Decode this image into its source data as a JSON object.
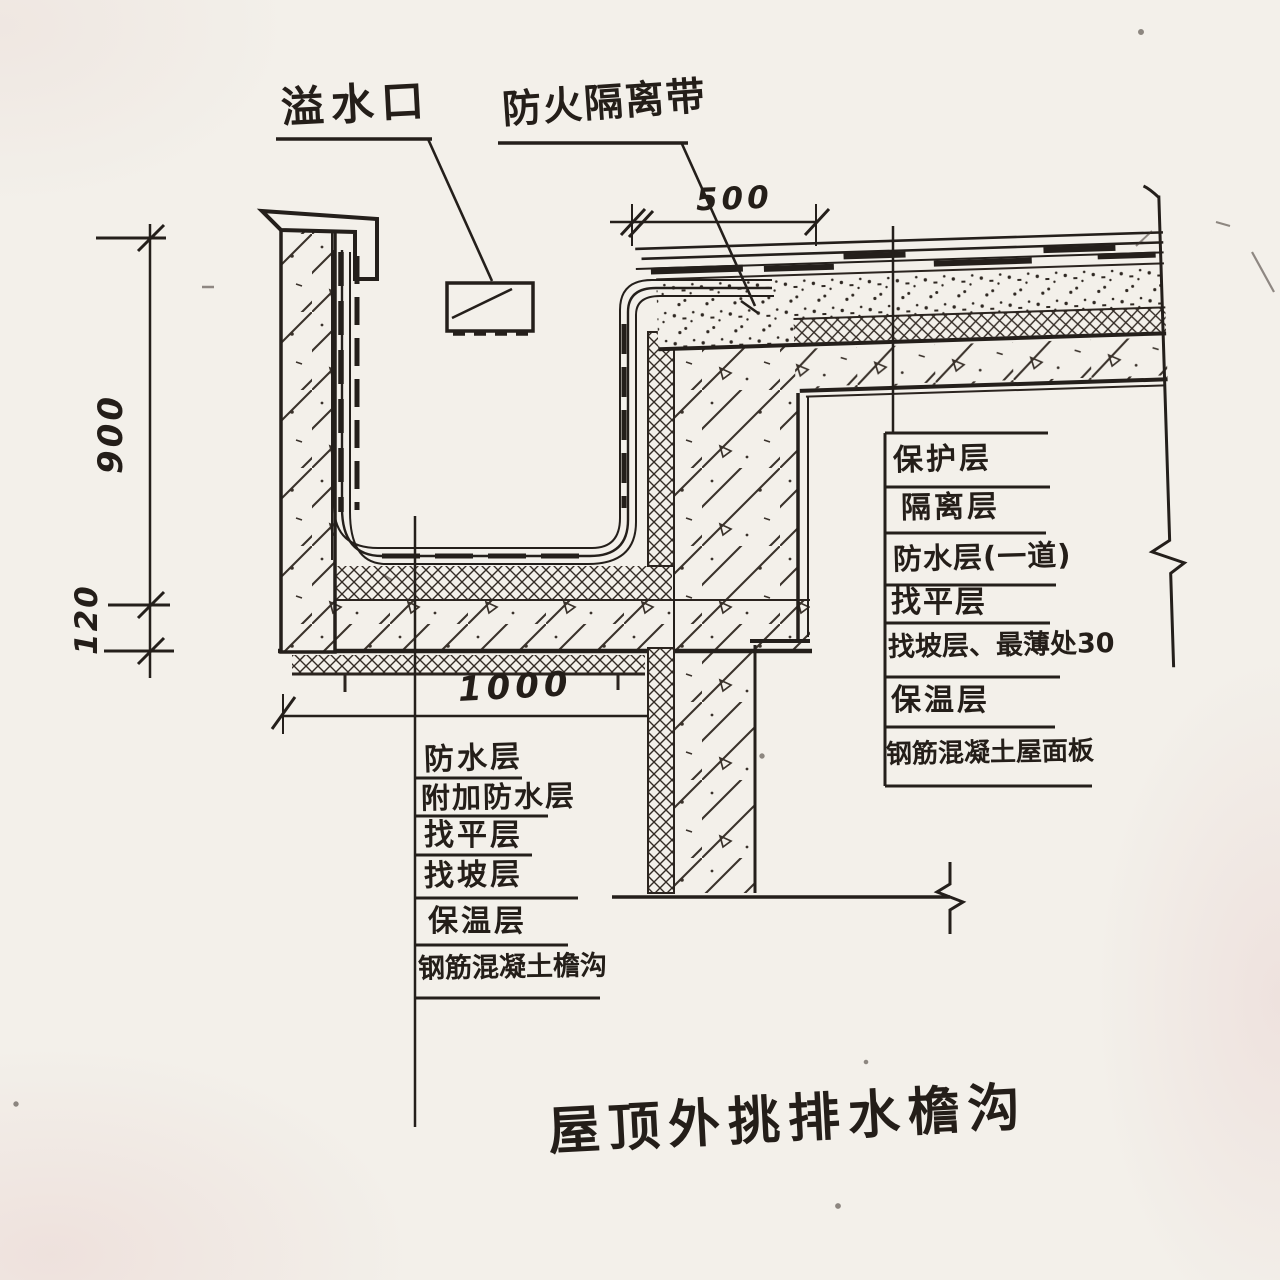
{
  "title": {
    "text": "屋顶外挑排水檐沟"
  },
  "callouts": {
    "overflow": "溢水口",
    "fire_break": "防火隔离带"
  },
  "dimensions": {
    "gutter_height": "900",
    "slab_thickness": "120",
    "fire_break_width": "500",
    "gutter_width": "1000"
  },
  "roof_layers": {
    "rows": [
      "保护层",
      "隔离层",
      "防水层(一道)",
      "找平层",
      "找坡层、最薄处30",
      "保温层",
      "钢筋混凝土屋面板"
    ]
  },
  "gutter_layers": {
    "rows": [
      "防水层",
      "附加防水层",
      "找平层",
      "找坡层",
      "保温层",
      "钢筋混凝土檐沟"
    ]
  },
  "colors": {
    "ink": "#2b241f",
    "paper": "#f3f0ea"
  }
}
